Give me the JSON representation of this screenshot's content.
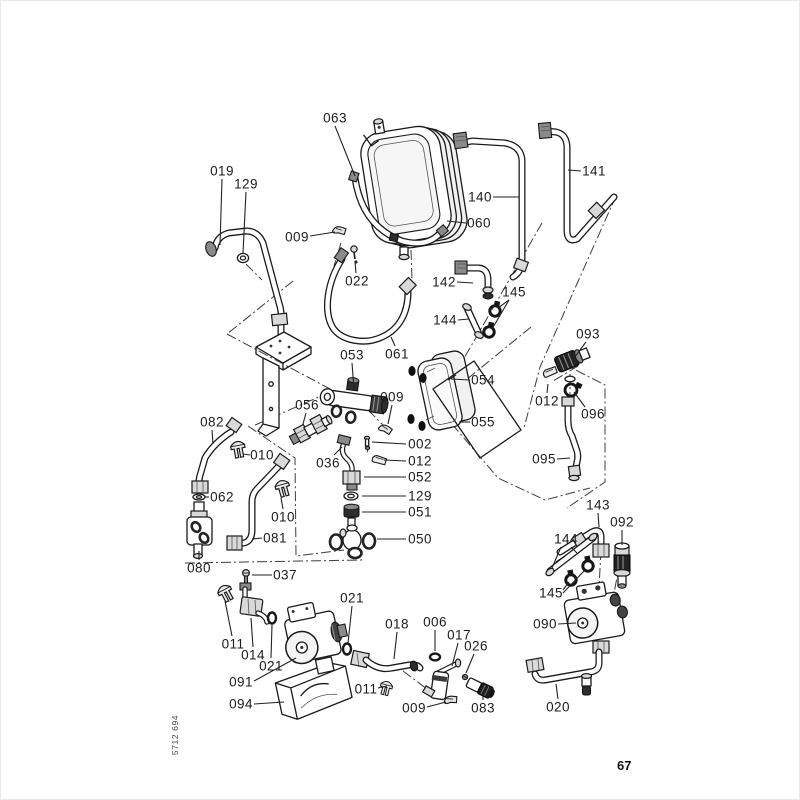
{
  "page": {
    "number": "67",
    "code": "5712 694"
  },
  "diagram": {
    "type": "exploded-parts-diagram",
    "labels": [
      {
        "text": "063",
        "x": 335,
        "y": 118,
        "leaders": [
          [
            [
              335,
              126
            ],
            [
              355,
              176
            ]
          ]
        ]
      },
      {
        "text": "019",
        "x": 222,
        "y": 171,
        "leaders": [
          [
            [
              222,
              179
            ],
            [
              220,
              245
            ]
          ]
        ]
      },
      {
        "text": "129",
        "x": 246,
        "y": 184,
        "leaders": [
          [
            [
              246,
              192
            ],
            [
              243,
              253
            ]
          ]
        ]
      },
      {
        "text": "009",
        "x": 297,
        "y": 237,
        "leaders": [
          [
            [
              310,
              236
            ],
            [
              335,
              232
            ]
          ]
        ]
      },
      {
        "text": "022",
        "x": 357,
        "y": 281,
        "leaders": [
          [
            [
              356,
              273
            ],
            [
              355,
              261
            ]
          ]
        ]
      },
      {
        "text": "140",
        "x": 480,
        "y": 197,
        "leaders": [
          [
            [
              493,
              197
            ],
            [
              519,
              197
            ]
          ]
        ]
      },
      {
        "text": "060",
        "x": 479,
        "y": 223,
        "leaders": [
          [
            [
              466,
              223
            ],
            [
              447,
              221
            ]
          ]
        ]
      },
      {
        "text": "141",
        "x": 594,
        "y": 171,
        "leaders": [
          [
            [
              581,
              171
            ],
            [
              568,
              170
            ]
          ]
        ]
      },
      {
        "text": "142",
        "x": 444,
        "y": 282,
        "leaders": [
          [
            [
              457,
              282
            ],
            [
              473,
              283
            ]
          ]
        ]
      },
      {
        "text": "145",
        "x": 514,
        "y": 292,
        "leaders": [
          [
            [
              509,
              300
            ],
            [
              498,
              308
            ]
          ],
          [
            [
              509,
              300
            ],
            [
              492,
              329
            ]
          ]
        ]
      },
      {
        "text": "144",
        "x": 445,
        "y": 320,
        "leaders": [
          [
            [
              458,
              320
            ],
            [
              469,
              319
            ]
          ]
        ]
      },
      {
        "text": "061",
        "x": 397,
        "y": 354,
        "leaders": [
          [
            [
              395,
              346
            ],
            [
              391,
              337
            ]
          ]
        ]
      },
      {
        "text": "053",
        "x": 352,
        "y": 355,
        "leaders": [
          [
            [
              352,
              363
            ],
            [
              354,
              389
            ]
          ]
        ]
      },
      {
        "text": "054",
        "x": 483,
        "y": 380,
        "leaders": [
          [
            [
              470,
              380
            ],
            [
              451,
              379
            ]
          ]
        ]
      },
      {
        "text": "055",
        "x": 483,
        "y": 422,
        "leaders": [
          [
            [
              470,
              422
            ],
            [
              459,
              422
            ]
          ]
        ]
      },
      {
        "text": "009",
        "x": 392,
        "y": 397,
        "leaders": [
          [
            [
              392,
              405
            ],
            [
              388,
              424
            ]
          ]
        ]
      },
      {
        "text": "056",
        "x": 307,
        "y": 405,
        "leaders": [
          [
            [
              306,
              413
            ],
            [
              303,
              424
            ]
          ]
        ]
      },
      {
        "text": "002",
        "x": 420,
        "y": 444,
        "leaders": [
          [
            [
              406,
              444
            ],
            [
              372,
              442
            ]
          ]
        ]
      },
      {
        "text": "012",
        "x": 420,
        "y": 461,
        "leaders": [
          [
            [
              406,
              461
            ],
            [
              384,
              460
            ]
          ]
        ]
      },
      {
        "text": "036",
        "x": 328,
        "y": 463,
        "leaders": [
          [
            [
              334,
              455
            ],
            [
              342,
              447
            ]
          ]
        ]
      },
      {
        "text": "052",
        "x": 420,
        "y": 477,
        "leaders": [
          [
            [
              406,
              477
            ],
            [
              364,
              477
            ]
          ]
        ]
      },
      {
        "text": "129",
        "x": 420,
        "y": 496,
        "leaders": [
          [
            [
              406,
              496
            ],
            [
              362,
              496
            ]
          ]
        ]
      },
      {
        "text": "051",
        "x": 420,
        "y": 512,
        "leaders": [
          [
            [
              406,
              512
            ],
            [
              362,
              512
            ]
          ]
        ]
      },
      {
        "text": "050",
        "x": 420,
        "y": 539,
        "leaders": [
          [
            [
              406,
              539
            ],
            [
              377,
              539
            ]
          ]
        ]
      },
      {
        "text": "082",
        "x": 212,
        "y": 422,
        "leaders": [
          [
            [
              212,
              430
            ],
            [
              213,
              444
            ]
          ]
        ]
      },
      {
        "text": "010",
        "x": 262,
        "y": 455,
        "leaders": [
          [
            [
              250,
              455
            ],
            [
              243,
              454
            ]
          ]
        ]
      },
      {
        "text": "062",
        "x": 222,
        "y": 497,
        "leaders": [
          [
            [
              209,
              497
            ],
            [
              205,
              497
            ]
          ]
        ]
      },
      {
        "text": "010",
        "x": 283,
        "y": 517,
        "leaders": [
          [
            [
              283,
              509
            ],
            [
              281,
              498
            ]
          ]
        ]
      },
      {
        "text": "081",
        "x": 275,
        "y": 538,
        "leaders": [
          [
            [
              262,
              538
            ],
            [
              252,
              539
            ]
          ]
        ]
      },
      {
        "text": "080",
        "x": 199,
        "y": 568,
        "leaders": [
          [
            [
              199,
              560
            ],
            [
              199,
              551
            ]
          ]
        ]
      },
      {
        "text": "037",
        "x": 285,
        "y": 575,
        "leaders": [
          [
            [
              272,
              575
            ],
            [
              252,
              575
            ]
          ]
        ]
      },
      {
        "text": "011",
        "x": 233,
        "y": 644,
        "leaders": [
          [
            [
              232,
              636
            ],
            [
              225,
              601
            ]
          ]
        ]
      },
      {
        "text": "014",
        "x": 253,
        "y": 655,
        "leaders": [
          [
            [
              253,
              647
            ],
            [
              251,
              618
            ]
          ]
        ]
      },
      {
        "text": "021",
        "x": 271,
        "y": 666,
        "leaders": [
          [
            [
              271,
              658
            ],
            [
              272,
              625
            ]
          ]
        ]
      },
      {
        "text": "091",
        "x": 241,
        "y": 682,
        "leaders": [
          [
            [
              254,
              681
            ],
            [
              296,
              658
            ]
          ]
        ]
      },
      {
        "text": "094",
        "x": 241,
        "y": 704,
        "leaders": [
          [
            [
              254,
              704
            ],
            [
              284,
              702
            ]
          ]
        ]
      },
      {
        "text": "021",
        "x": 352,
        "y": 598,
        "leaders": [
          [
            [
              352,
              606
            ],
            [
              348,
              643
            ]
          ]
        ]
      },
      {
        "text": "018",
        "x": 397,
        "y": 624,
        "leaders": [
          [
            [
              397,
              632
            ],
            [
              394,
              659
            ]
          ]
        ]
      },
      {
        "text": "006",
        "x": 435,
        "y": 622,
        "leaders": [
          [
            [
              435,
              630
            ],
            [
              435,
              651
            ]
          ]
        ]
      },
      {
        "text": "017",
        "x": 459,
        "y": 635,
        "leaders": [
          [
            [
              458,
              643
            ],
            [
              452,
              666
            ]
          ]
        ]
      },
      {
        "text": "026",
        "x": 476,
        "y": 646,
        "leaders": [
          [
            [
              474,
              654
            ],
            [
              466,
              673
            ]
          ]
        ]
      },
      {
        "text": "011",
        "x": 366,
        "y": 689,
        "leaders": [
          [
            [
              378,
              688
            ],
            [
              387,
              686
            ]
          ]
        ]
      },
      {
        "text": "009",
        "x": 414,
        "y": 708,
        "leaders": [
          [
            [
              427,
              707
            ],
            [
              446,
              702
            ]
          ]
        ]
      },
      {
        "text": "083",
        "x": 483,
        "y": 708,
        "leaders": [
          [
            [
              483,
              700
            ],
            [
              483,
              694
            ]
          ]
        ]
      },
      {
        "text": "093",
        "x": 588,
        "y": 334,
        "leaders": [
          [
            [
              586,
              342
            ],
            [
              574,
              358
            ]
          ]
        ]
      },
      {
        "text": "012",
        "x": 547,
        "y": 401,
        "leaders": [
          [
            [
              547,
              393
            ],
            [
              548,
              384
            ]
          ]
        ]
      },
      {
        "text": "096",
        "x": 593,
        "y": 414,
        "leaders": [
          [
            [
              585,
              407
            ],
            [
              574,
              392
            ]
          ]
        ]
      },
      {
        "text": "095",
        "x": 544,
        "y": 459,
        "leaders": [
          [
            [
              557,
              459
            ],
            [
              570,
              458
            ]
          ]
        ]
      },
      {
        "text": "143",
        "x": 598,
        "y": 505,
        "leaders": [
          [
            [
              598,
              513
            ],
            [
              599,
              527
            ]
          ]
        ]
      },
      {
        "text": "092",
        "x": 622,
        "y": 522,
        "leaders": [
          [
            [
              622,
              530
            ],
            [
              622,
              545
            ]
          ]
        ]
      },
      {
        "text": "144",
        "x": 566,
        "y": 539,
        "leaders": [
          [
            [
              561,
              547
            ],
            [
              552,
              568
            ]
          ],
          [
            [
              571,
              547
            ],
            [
              577,
              553
            ]
          ]
        ]
      },
      {
        "text": "145",
        "x": 551,
        "y": 593,
        "leaders": [
          [
            [
              563,
              590
            ],
            [
              569,
              582
            ]
          ],
          [
            [
              563,
              593
            ],
            [
              585,
              570
            ]
          ]
        ]
      },
      {
        "text": "090",
        "x": 545,
        "y": 624,
        "leaders": [
          [
            [
              558,
              624
            ],
            [
              576,
              623
            ]
          ]
        ]
      },
      {
        "text": "020",
        "x": 558,
        "y": 707,
        "leaders": [
          [
            [
              558,
              699
            ],
            [
              556,
              684
            ]
          ]
        ]
      }
    ]
  }
}
